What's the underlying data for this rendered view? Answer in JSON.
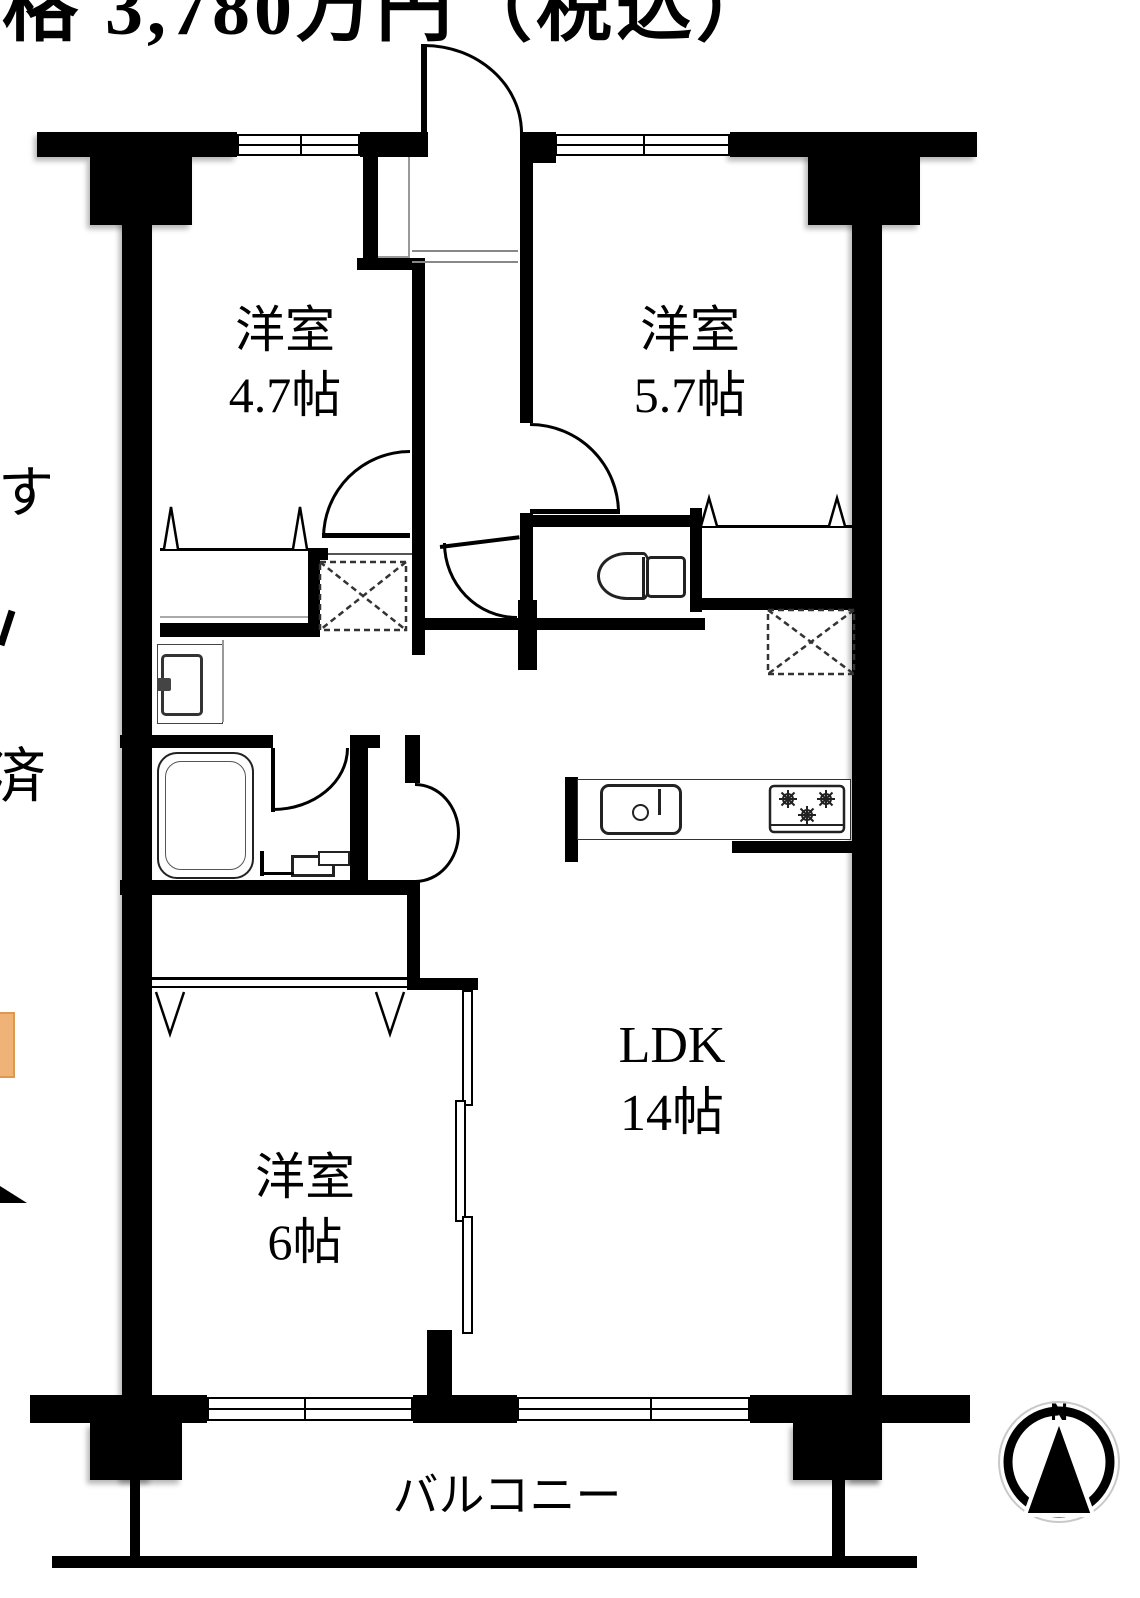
{
  "header": {
    "price_text": "格 3,780万円（税込）"
  },
  "left_margin_fragments": {
    "fragment_top": "す",
    "fragment_bottom": "済"
  },
  "floorplan": {
    "rooms": [
      {
        "name": "洋室",
        "size": "4.7帖"
      },
      {
        "name": "洋室",
        "size": "5.7帖"
      },
      {
        "name": "洋室",
        "size": "6帖"
      },
      {
        "name": "LDK",
        "size": "14帖"
      }
    ],
    "balcony_label": "バルコニー",
    "compass_north_label": "N",
    "colors": {
      "wall_black": "#000000",
      "accent_orange": "#f0b377",
      "step_line_gray": "#777777"
    }
  }
}
